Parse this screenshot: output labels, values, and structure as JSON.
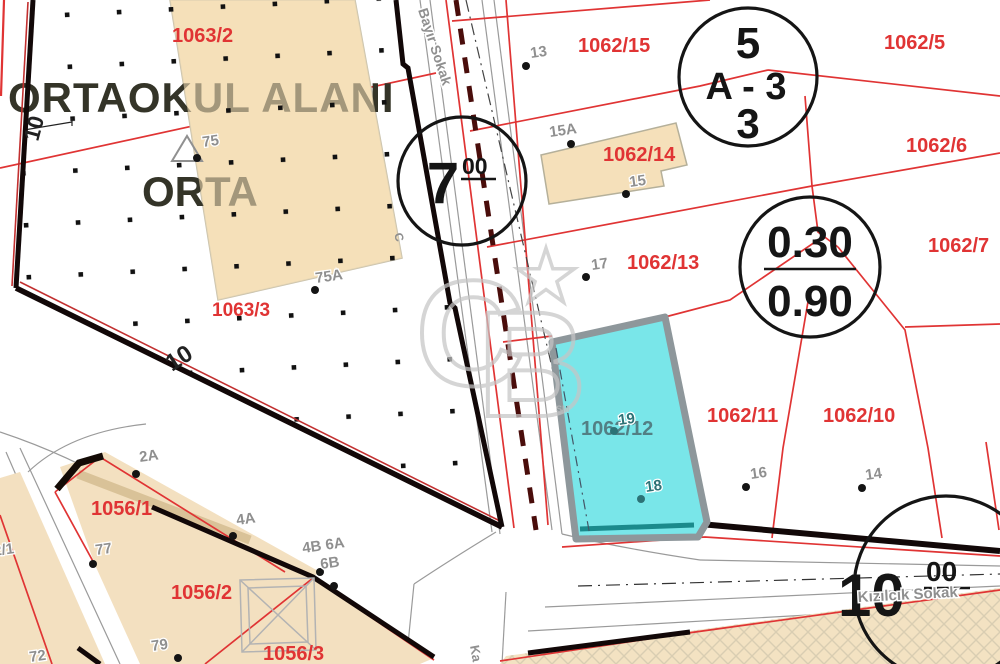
{
  "colors": {
    "red": "#e03434",
    "gray_label": "#8f8f8f",
    "dark": "#222222",
    "teal": "#2c7276",
    "cyan_label": "#527f84",
    "maroon": "#4a0d0b",
    "cyan_fill": "#79e6e9",
    "beige": "#f5e2bd",
    "black_line": "#141414"
  },
  "school": {
    "title": "ORTAOKUL ALANI",
    "subtitle": "ORTA"
  },
  "watermark": {
    "c": "C",
    "b": "B",
    "tm": "SM"
  },
  "labels": [
    {
      "name": "parcel-label-1063-2",
      "t": "1063/2",
      "x": 172,
      "y": 42
    },
    {
      "name": "parcel-label-1063-3",
      "t": "1063/3",
      "x": 212,
      "y": 316,
      "s": 19
    },
    {
      "name": "parcel-label-1062-15",
      "t": "1062/15",
      "x": 578,
      "y": 52
    },
    {
      "name": "parcel-label-1062-5",
      "t": "1062/5",
      "x": 884,
      "y": 49
    },
    {
      "name": "parcel-label-1062-14",
      "t": "1062/14",
      "x": 603,
      "y": 161
    },
    {
      "name": "parcel-label-1062-6",
      "t": "1062/6",
      "x": 906,
      "y": 152
    },
    {
      "name": "parcel-label-1062-13",
      "t": "1062/13",
      "x": 627,
      "y": 269
    },
    {
      "name": "parcel-label-1062-7",
      "t": "1062/7",
      "x": 928,
      "y": 252
    },
    {
      "name": "parcel-label-1062-11",
      "t": "1062/11",
      "x": 707,
      "y": 422
    },
    {
      "name": "parcel-label-1062-10",
      "t": "1062/10",
      "x": 823,
      "y": 422
    },
    {
      "name": "parcel-label-1062-12",
      "t": "1062/12",
      "x": 581,
      "y": 435,
      "c": "#527f84"
    },
    {
      "name": "parcel-label-1056-1",
      "t": "1056/1",
      "x": 91,
      "y": 515
    },
    {
      "name": "parcel-label-1056-2",
      "t": "1056/2",
      "x": 171,
      "y": 599
    },
    {
      "name": "parcel-label-1056-3",
      "t": "1056/3",
      "x": 263,
      "y": 660
    },
    {
      "name": "street-name-bayir",
      "t": "Bayır Sokak",
      "x": 418,
      "y": 10,
      "s": 14,
      "c": "#8f8f8f",
      "r": 72,
      "h": true
    },
    {
      "name": "street-name-kizilcik",
      "t": "Kızılcık Sokak",
      "x": 858,
      "y": 602,
      "s": 15,
      "c": "#8f8f8f",
      "r": -3,
      "h": true
    },
    {
      "name": "street-name-south-clipped",
      "t": "Ka",
      "x": 470,
      "y": 646,
      "s": 13,
      "c": "#8f8f8f",
      "r": 80,
      "h": true
    },
    {
      "name": "road-width-10-left",
      "t": "10",
      "x": 38,
      "y": 142,
      "s": 22,
      "c": "#222222",
      "r": -75
    },
    {
      "name": "road-width-10-diagonal",
      "t": "10",
      "x": 172,
      "y": 372,
      "s": 24,
      "c": "#222222",
      "r": -33
    },
    {
      "name": "road-letter-c",
      "t": "C",
      "x": 394,
      "y": 234,
      "s": 12,
      "c": "#8f8f8f",
      "r": 75
    }
  ],
  "points": [
    {
      "name": "survey-point-13",
      "label": "13",
      "x": 526,
      "y": 66,
      "lx": 531,
      "ly": 58
    },
    {
      "name": "survey-point-15a",
      "label": "15A",
      "x": 571,
      "y": 144,
      "lx": 550,
      "ly": 137
    },
    {
      "name": "survey-point-15",
      "label": "15",
      "x": 626,
      "y": 194,
      "lx": 630,
      "ly": 187
    },
    {
      "name": "survey-point-17",
      "label": "17",
      "x": 586,
      "y": 277,
      "lx": 592,
      "ly": 270
    },
    {
      "name": "survey-point-19",
      "label": "19",
      "x": 614,
      "y": 431,
      "lx": 619,
      "ly": 425,
      "c": "#2c7276"
    },
    {
      "name": "survey-point-18",
      "label": "18",
      "x": 641,
      "y": 499,
      "lx": 646,
      "ly": 492,
      "c": "#2c7276"
    },
    {
      "name": "survey-point-16",
      "label": "16",
      "x": 746,
      "y": 487,
      "lx": 751,
      "ly": 479
    },
    {
      "name": "survey-point-14",
      "label": "14",
      "x": 862,
      "y": 488,
      "lx": 866,
      "ly": 480
    },
    {
      "name": "survey-point-2a",
      "label": "2A",
      "x": 136,
      "y": 474,
      "lx": 140,
      "ly": 462
    },
    {
      "name": "survey-point-4a",
      "label": "4A",
      "x": 233,
      "y": 536,
      "lx": 237,
      "ly": 525
    },
    {
      "name": "survey-point-77",
      "label": "77",
      "x": 93,
      "y": 564,
      "lx": 96,
      "ly": 555
    },
    {
      "name": "survey-point-4b6a",
      "label": "4B 6A",
      "x": 320,
      "y": 572,
      "lx": 303,
      "ly": 553
    },
    {
      "name": "survey-point-6b",
      "label": "6B",
      "x": 334,
      "y": 586,
      "lx": 321,
      "ly": 569
    },
    {
      "name": "survey-point-79",
      "label": "79",
      "x": 178,
      "y": 658,
      "lx": 152,
      "ly": 651
    },
    {
      "name": "survey-point-72",
      "label": "72",
      "dot": false,
      "lx": 30,
      "ly": 662
    },
    {
      "name": "survey-point-2-1",
      "label": "2/1",
      "dot": false,
      "lx": -6,
      "ly": 556
    },
    {
      "name": "survey-point-75",
      "label": "75",
      "x": 197,
      "y": 158,
      "lx": 203,
      "ly": 147
    },
    {
      "name": "survey-point-75a",
      "label": "75A",
      "x": 315,
      "y": 290,
      "lx": 316,
      "ly": 283
    }
  ],
  "circles": [
    {
      "name": "plan-note-7-00",
      "cx": 462,
      "cy": 181,
      "r": 64,
      "texts": [
        {
          "t": "7",
          "x": 443,
          "y": 203,
          "s": 58,
          "a": "middle"
        },
        {
          "t": "00",
          "x": 462,
          "y": 174,
          "s": 23
        }
      ],
      "bars": [
        [
          461,
          179,
          496,
          179
        ]
      ]
    },
    {
      "name": "zoning-note-a3",
      "cx": 748,
      "cy": 77,
      "r": 69,
      "texts": [
        {
          "t": "5",
          "x": 748,
          "y": 58,
          "s": 44,
          "a": "middle"
        },
        {
          "t": "A - 3",
          "x": 746,
          "y": 99,
          "s": 38,
          "a": "middle"
        },
        {
          "t": "3",
          "x": 748,
          "y": 138,
          "s": 42,
          "a": "middle"
        }
      ],
      "bars": []
    },
    {
      "name": "ratio-note-030-090",
      "cx": 810,
      "cy": 267,
      "r": 70,
      "texts": [
        {
          "t": "0.30",
          "x": 810,
          "y": 257,
          "s": 44,
          "a": "middle"
        },
        {
          "t": "0.90",
          "x": 810,
          "y": 316,
          "s": 44,
          "a": "middle"
        }
      ],
      "bars": [
        [
          764,
          269,
          856,
          269
        ]
      ]
    },
    {
      "name": "plan-note-10-00",
      "cx": 946,
      "cy": 588,
      "r": 92,
      "texts": [
        {
          "t": "10",
          "x": 838,
          "y": 616,
          "s": 60
        },
        {
          "t": "00",
          "x": 926,
          "y": 581,
          "s": 28
        }
      ],
      "bars": [
        [
          924,
          588,
          970,
          588
        ]
      ]
    }
  ]
}
